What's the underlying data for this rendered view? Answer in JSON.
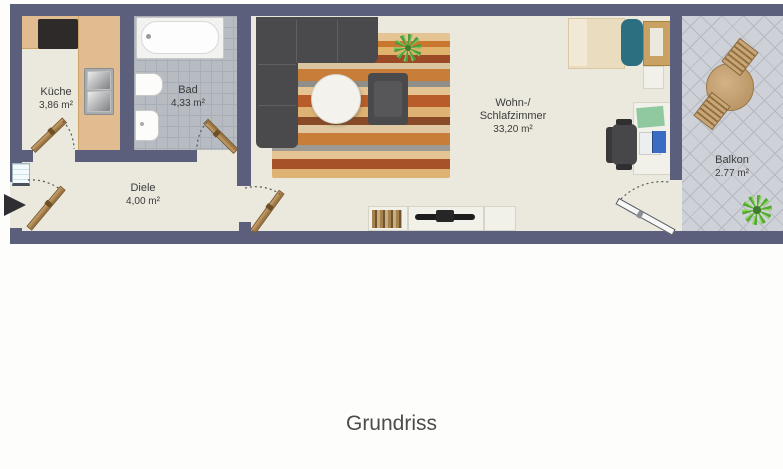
{
  "caption": "Grundriss",
  "rooms": {
    "kueche": {
      "name": "Küche",
      "area": "3,86 m²"
    },
    "bad": {
      "name": "Bad",
      "area": "4,33 m²"
    },
    "diele": {
      "name": "Diele",
      "area": "4,00 m²"
    },
    "wohn_schlafzimmer": {
      "name_line1": "Wohn-/",
      "name_line2": "Schlafzimmer",
      "area": "33,20 m²"
    },
    "balkon": {
      "name": "Balkon",
      "area": "2.77 m²"
    }
  },
  "icons": {
    "entrance_arrow": "right-pointing-triangle",
    "furniture": [
      "stove",
      "kitchen-sink",
      "bathtub",
      "toilet",
      "washbasin",
      "corner-sofa",
      "rug",
      "coffee-table",
      "armchair",
      "potted-plant",
      "lowboard",
      "books",
      "tv",
      "bed",
      "pillow",
      "headboard",
      "nightstand",
      "desk",
      "desk-pad",
      "laptop",
      "office-chair",
      "balcony-table",
      "balcony-chair",
      "balcony-plant"
    ]
  },
  "colors": {
    "wall": "#5b5f7b",
    "floor": "#ebe8dd",
    "counter": "#e2bc91",
    "bathtile": "#b7bbc2",
    "balctile": "#ced2d8",
    "sofa": "#4a4a4c",
    "teal": "#2b6f80",
    "wood-door": "#b9905e"
  }
}
